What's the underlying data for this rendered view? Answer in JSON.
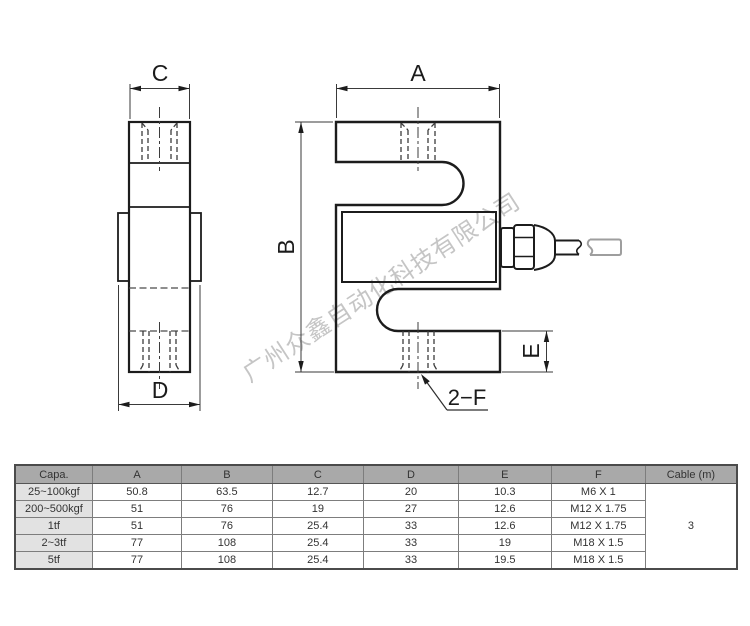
{
  "drawing": {
    "dimension_labels": {
      "A": "A",
      "B": "B",
      "C": "C",
      "D": "D",
      "E": "E"
    },
    "thread_callout": "2−F",
    "watermark": "广州众鑫自动化科技有限公司"
  },
  "table": {
    "headers": [
      "Capa.",
      "A",
      "B",
      "C",
      "D",
      "E",
      "F",
      "Cable (m)"
    ],
    "rows": [
      {
        "capa": "25~100kgf",
        "a": "50.8",
        "b": "63.5",
        "c": "12.7",
        "d": "20",
        "e": "10.3",
        "f": "M6 X 1"
      },
      {
        "capa": "200~500kgf",
        "a": "51",
        "b": "76",
        "c": "19",
        "d": "27",
        "e": "12.6",
        "f": "M12 X 1.75"
      },
      {
        "capa": "1tf",
        "a": "51",
        "b": "76",
        "c": "25.4",
        "d": "33",
        "e": "12.6",
        "f": "M12 X 1.75"
      },
      {
        "capa": "2~3tf",
        "a": "77",
        "b": "108",
        "c": "25.4",
        "d": "33",
        "e": "19",
        "f": "M18 X 1.5"
      },
      {
        "capa": "5tf",
        "a": "77",
        "b": "108",
        "c": "25.4",
        "d": "33",
        "e": "19.5",
        "f": "M18 X 1.5"
      }
    ],
    "cable_length": "3"
  },
  "colors": {
    "line": "#1c1c1c",
    "dimension_line": "#3a3a3a",
    "hidden_line": "#4a4a4a",
    "header_bg": "#a9a9a9",
    "capa_bg": "#e2e2e2",
    "watermark": "#c5c5c5",
    "cable_tail": "#9e9e9e"
  }
}
